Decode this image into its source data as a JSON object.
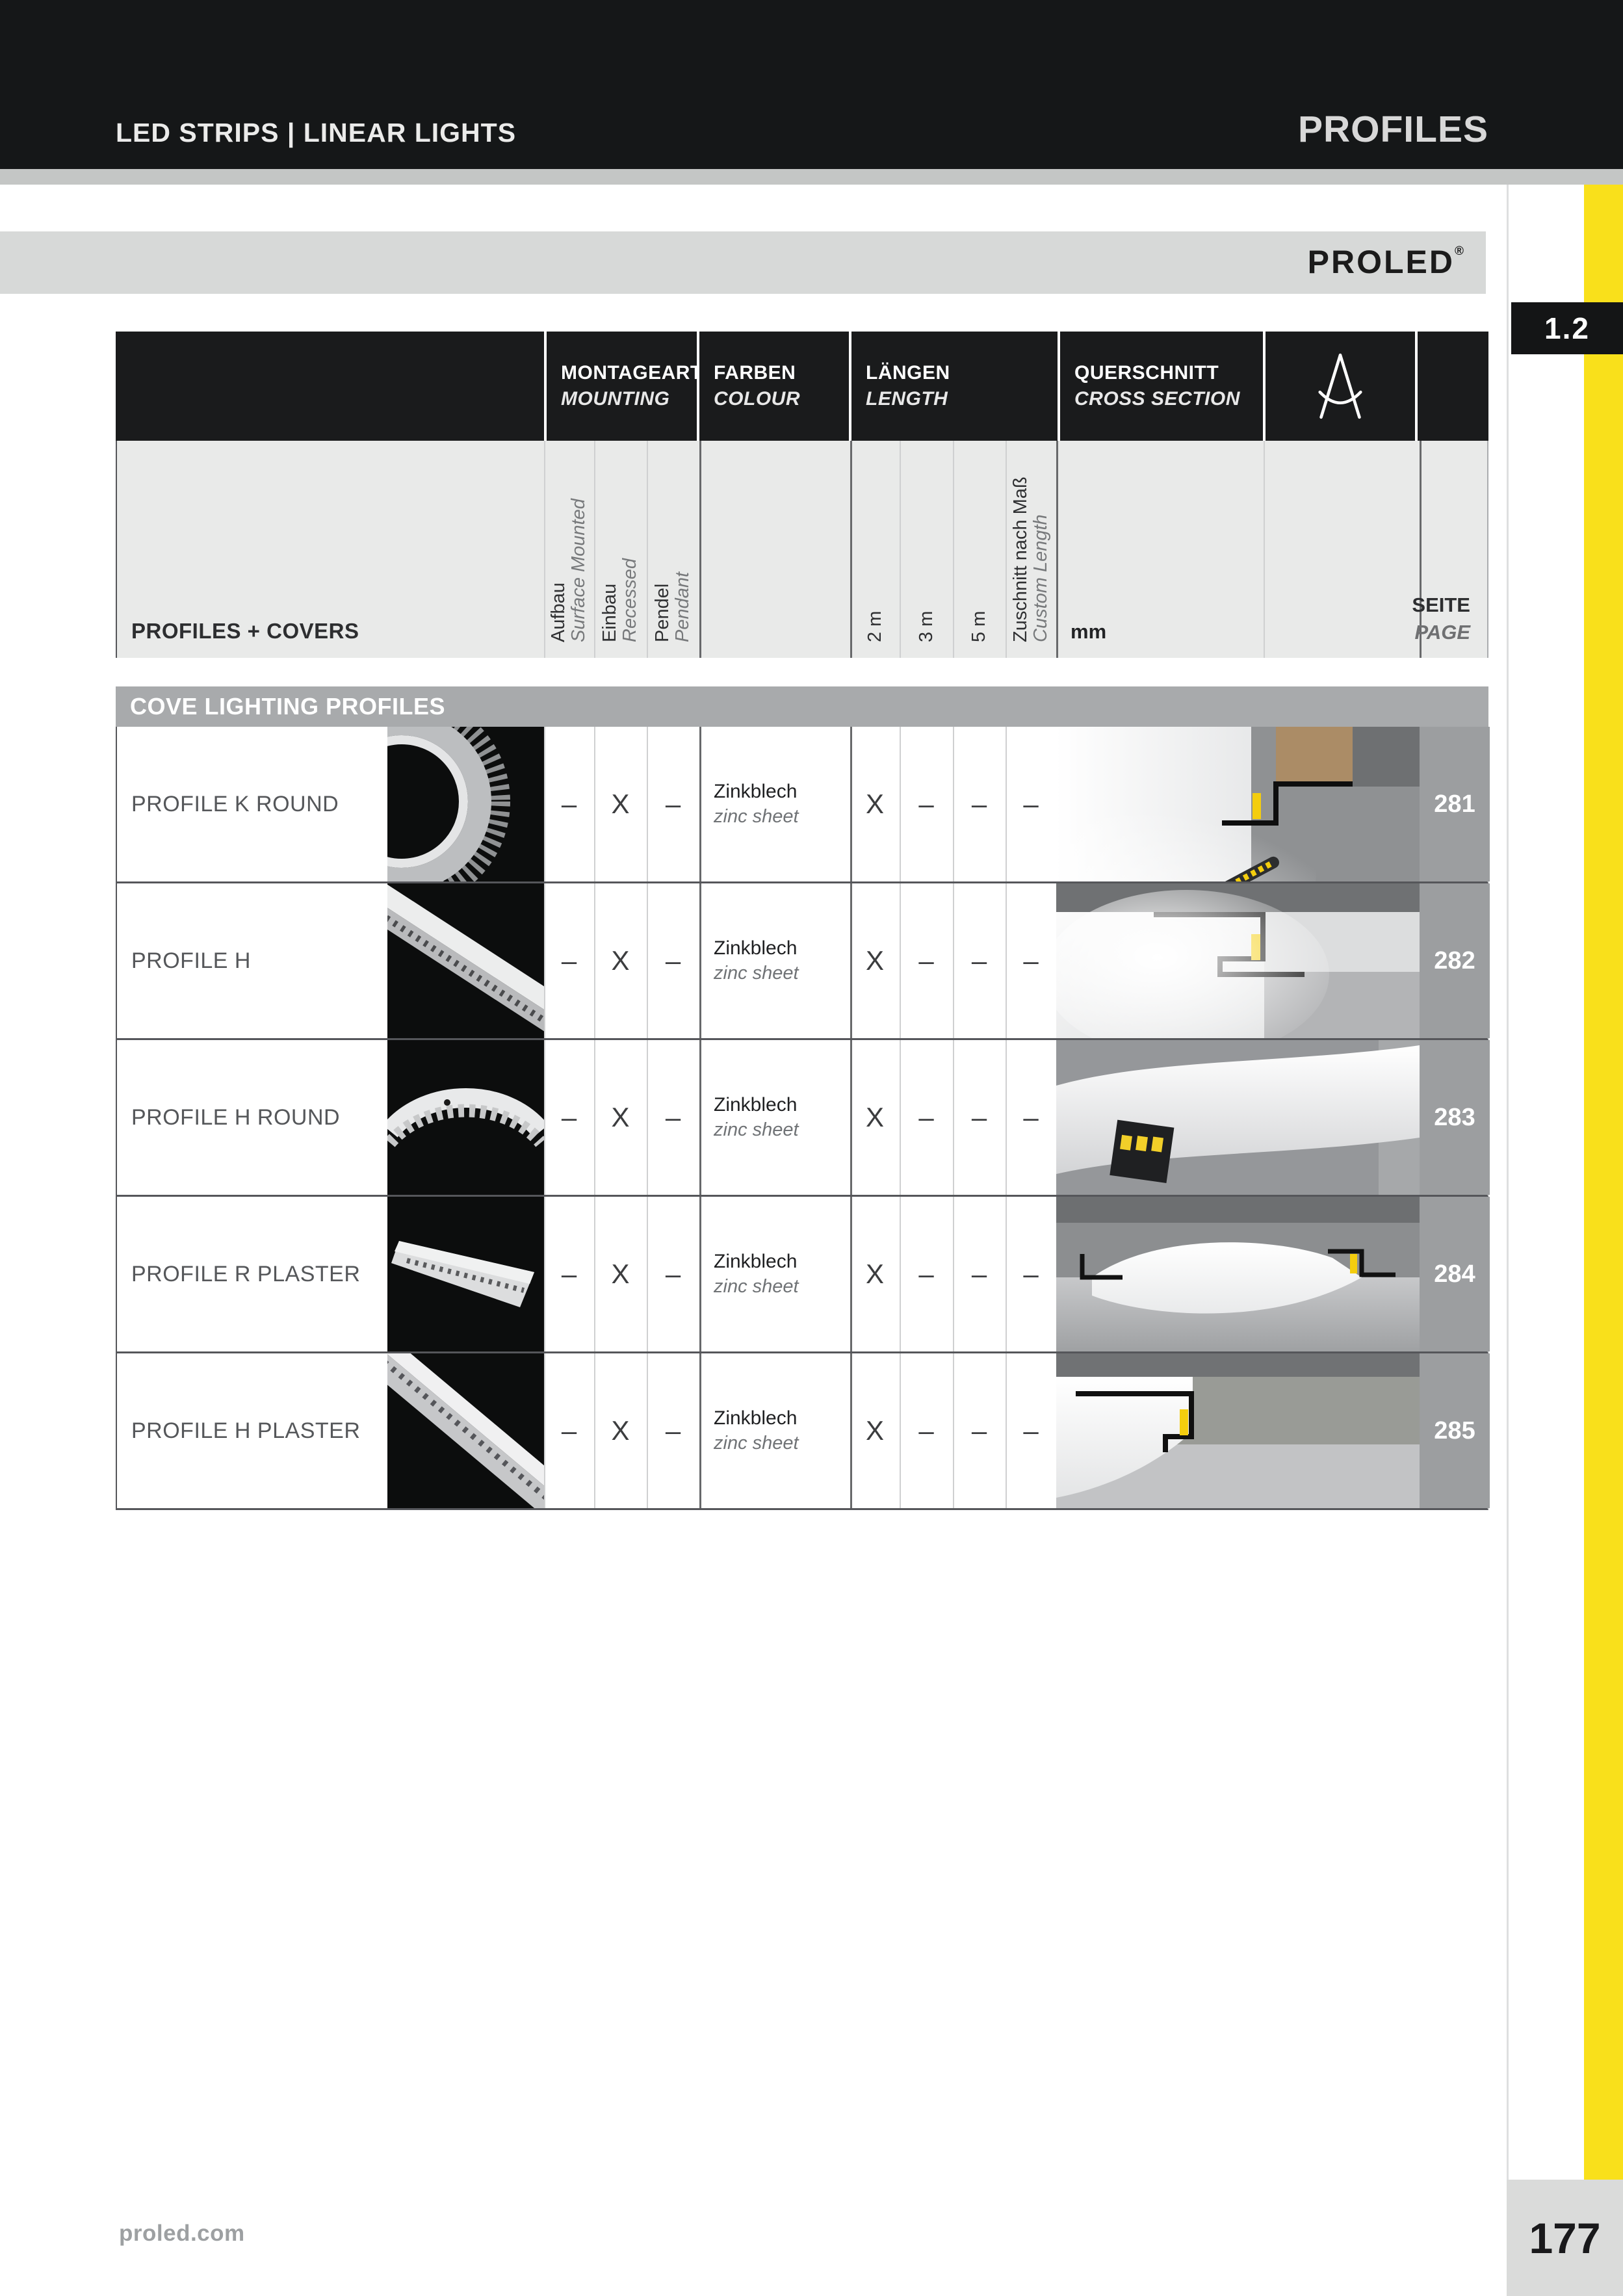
{
  "header": {
    "left": "LED STRIPS | LINEAR LIGHTS",
    "right": "PROFILES"
  },
  "brand": {
    "name": "PROLED",
    "registered": "®"
  },
  "section_tab": "1.2",
  "table": {
    "groups": {
      "mounting_de": "MONTAGEART",
      "mounting_en": "MOUNTING",
      "colour_de": "FARBEN",
      "colour_en": "COLOUR",
      "length_de": "LÄNGEN",
      "length_en": "LENGTH",
      "cross_de": "QUERSCHNITT",
      "cross_en": "CROSS SECTION"
    },
    "row_header": "PROFILES + COVERS",
    "cols": {
      "surface_de": "Aufbau",
      "surface_en": "Surface Mounted",
      "recessed_de": "Einbau",
      "recessed_en": "Recessed",
      "pendant_de": "Pendel",
      "pendant_en": "Pendant",
      "m2": "2 m",
      "m3": "3 m",
      "m5": "5 m",
      "custom_de": "Zuschnitt nach Maß",
      "custom_en": "Custom Length",
      "mm": "mm",
      "page_de": "SEITE",
      "page_en": "PAGE"
    },
    "section": "COVE LIGHTING PROFILES",
    "rows": [
      {
        "name": "PROFILE K ROUND",
        "surface": "–",
        "recessed": "X",
        "pendant": "–",
        "colour_de": "Zinkblech",
        "colour_en": "zinc sheet",
        "m2": "X",
        "m3": "–",
        "m5": "–",
        "custom": "–",
        "page": "281"
      },
      {
        "name": "PROFILE H",
        "surface": "–",
        "recessed": "X",
        "pendant": "–",
        "colour_de": "Zinkblech",
        "colour_en": "zinc sheet",
        "m2": "X",
        "m3": "–",
        "m5": "–",
        "custom": "–",
        "page": "282"
      },
      {
        "name": "PROFILE H ROUND",
        "surface": "–",
        "recessed": "X",
        "pendant": "–",
        "colour_de": "Zinkblech",
        "colour_en": "zinc sheet",
        "m2": "X",
        "m3": "–",
        "m5": "–",
        "custom": "–",
        "page": "283"
      },
      {
        "name": "PROFILE R PLASTER",
        "surface": "–",
        "recessed": "X",
        "pendant": "–",
        "colour_de": "Zinkblech",
        "colour_en": "zinc sheet",
        "m2": "X",
        "m3": "–",
        "m5": "–",
        "custom": "–",
        "page": "284"
      },
      {
        "name": "PROFILE H PLASTER",
        "surface": "–",
        "recessed": "X",
        "pendant": "–",
        "colour_de": "Zinkblech",
        "colour_en": "zinc sheet",
        "m2": "X",
        "m3": "–",
        "m5": "–",
        "custom": "–",
        "page": "285"
      }
    ]
  },
  "footer": {
    "url": "proled.com",
    "page": "177"
  },
  "colors": {
    "accent_yellow": "#f9e01b",
    "bar_black": "#151718",
    "section_gray": "#a8aaac",
    "led_yellow": "#f4cd0e"
  }
}
